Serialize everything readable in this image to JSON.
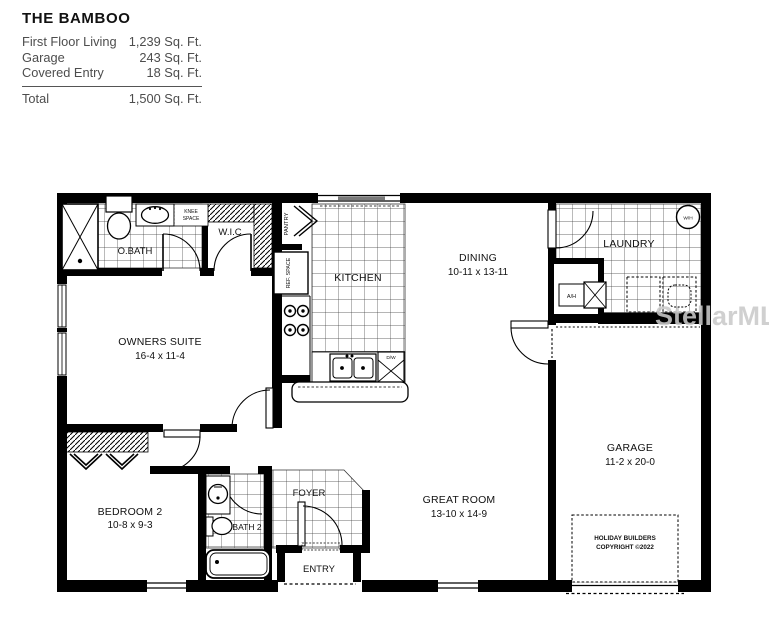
{
  "header": {
    "title": "THE BAMBOO",
    "rows": [
      {
        "label": "First Floor Living",
        "value": "1,239 Sq. Ft."
      },
      {
        "label": "Garage",
        "value": "243 Sq. Ft."
      },
      {
        "label": "Covered Entry",
        "value": "18 Sq. Ft."
      }
    ],
    "total": {
      "label": "Total",
      "value": "1,500 Sq. Ft."
    }
  },
  "rooms": {
    "owners_suite": {
      "name": "OWNERS SUITE",
      "dims": "16-4 x 11-4"
    },
    "bedroom2": {
      "name": "BEDROOM 2",
      "dims": "10-8 x 9-3"
    },
    "dining": {
      "name": "DINING",
      "dims": "10-11 x 13-11"
    },
    "great_room": {
      "name": "GREAT ROOM",
      "dims": "13-10 x 14-9"
    },
    "garage": {
      "name": "GARAGE",
      "dims": "11-2 x 20-0"
    },
    "kitchen": {
      "name": "KITCHEN"
    },
    "laundry": {
      "name": "LAUNDRY"
    },
    "obath": {
      "name": "O.BATH"
    },
    "bath2": {
      "name": "BATH 2"
    },
    "wic": {
      "name": "W.I.C"
    },
    "foyer": {
      "name": "FOYER"
    },
    "entry": {
      "name": "ENTRY"
    }
  },
  "labels": {
    "pantry": "PANTRY",
    "ref_space": "REF. SPACE",
    "knee_line1": "KNEE",
    "knee_line2": "SPACE",
    "water_heater": "W/H",
    "air_handler": "A/H",
    "dishwasher": "D/W"
  },
  "builder": {
    "line1": "HOLIDAY BUILDERS",
    "line2": "COPYRIGHT ©2022"
  },
  "watermark": {
    "text": "StellarMLS"
  },
  "colors": {
    "wall": "#000000",
    "tile_line": "#3a3a3a",
    "window_bar": "#7a7a7a",
    "watermark": "#c9c9c9"
  }
}
